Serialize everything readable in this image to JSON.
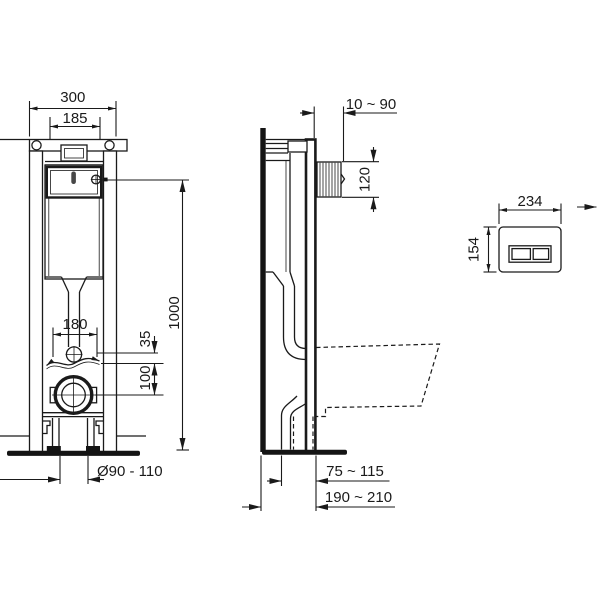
{
  "drawing_title": "in-wall wc frame installation dimensions",
  "units_note": "mm",
  "front_view": {
    "frame_width": "300",
    "cistern_width": "185",
    "fixing_distance": "180",
    "flush_pipe_offset": "35",
    "outlet_offset": "100",
    "frame_height": "1000",
    "outlet_diameter": "Ø90 - 110"
  },
  "side_view": {
    "wall_finish_range": "10 ~ 90",
    "flush_bend_height": "120",
    "outlet_to_wall": "75 ~ 115",
    "frame_depth": "190 ~ 210"
  },
  "flush_plate": {
    "plate_width": "234",
    "plate_height": "154"
  }
}
